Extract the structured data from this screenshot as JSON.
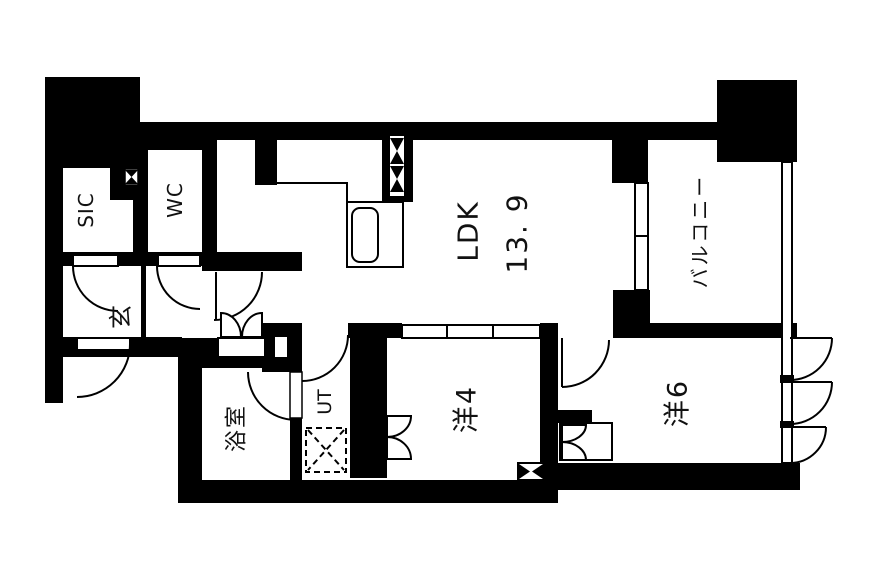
{
  "floor_plan": {
    "rooms": {
      "sic": {
        "label": "SIC"
      },
      "wc": {
        "label": "WC"
      },
      "entrance": {
        "label": "玄"
      },
      "ldk": {
        "label": "LDK",
        "area": "13. 9"
      },
      "balcony": {
        "label": "バルコニー"
      },
      "bath": {
        "label": "浴室"
      },
      "utility": {
        "label": "UT"
      },
      "western4": {
        "label": "洋4"
      },
      "western6": {
        "label": "洋6"
      }
    },
    "colors": {
      "wall": "#000000",
      "floor": "#ffffff",
      "line": "#111111"
    }
  }
}
